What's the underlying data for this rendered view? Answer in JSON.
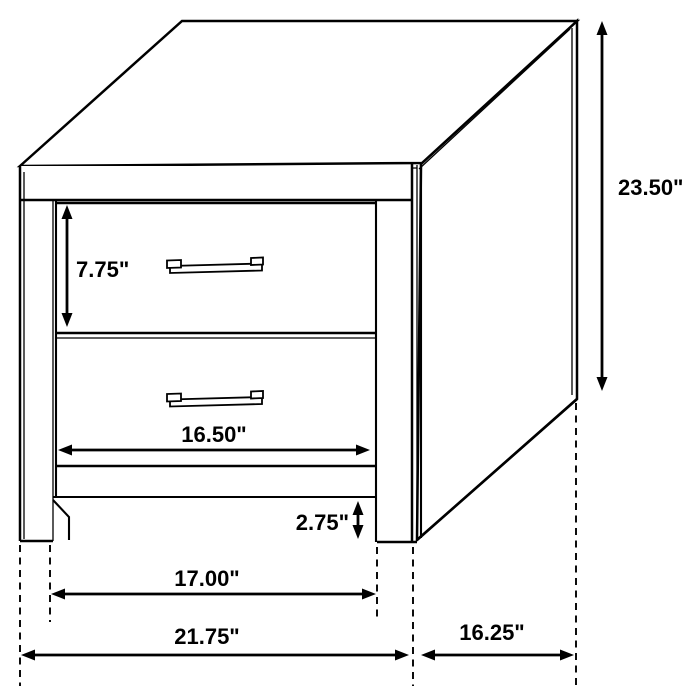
{
  "figure": {
    "kind": "furniture-dimension-diagram",
    "item": "two-drawer nightstand",
    "units": "inches",
    "line_color": "#000000",
    "background_color": "#ffffff",
    "measurements": {
      "overall_height_in": 23.5,
      "overall_width_in": 21.75,
      "depth_in": 16.25,
      "top_drawer_height_in": 7.75,
      "drawer_width_in": 16.5,
      "base_clearance_in": 2.75,
      "leg_span_in": 17.0
    }
  },
  "dimensions": [
    {
      "id": "overall-height",
      "label": "23.50\"",
      "type": "v",
      "x": 602,
      "y1": 21,
      "y2": 391,
      "lx": 618,
      "ly": 195,
      "anchor": "start"
    },
    {
      "id": "top-drawer-height",
      "label": "7.75\"",
      "type": "v",
      "x": 67,
      "y1": 205,
      "y2": 327,
      "lx": 76,
      "ly": 277,
      "anchor": "start"
    },
    {
      "id": "drawer-width",
      "label": "16.50\"",
      "type": "h",
      "y": 450,
      "x1": 58,
      "x2": 370,
      "lx": 214,
      "ly": 442,
      "anchor": "middle"
    },
    {
      "id": "base-height",
      "label": "2.75\"",
      "type": "v",
      "x": 358,
      "y1": 501,
      "y2": 539,
      "lx": 349,
      "ly": 530,
      "anchor": "end"
    },
    {
      "id": "leg-span",
      "label": "17.00\"",
      "type": "h",
      "y": 594,
      "x1": 51,
      "x2": 376,
      "lx": 207,
      "ly": 586,
      "anchor": "middle"
    },
    {
      "id": "overall-width",
      "label": "21.75\"",
      "type": "h",
      "y": 655,
      "x1": 21,
      "x2": 409,
      "lx": 207,
      "ly": 644,
      "anchor": "middle"
    },
    {
      "id": "depth",
      "label": "16.25\"",
      "type": "h",
      "y": 655,
      "x1": 421,
      "x2": 574,
      "lx": 492,
      "ly": 640,
      "anchor": "middle"
    }
  ],
  "extension_lines": [
    {
      "id": "left-outer",
      "x": 20,
      "y1": 545,
      "y2": 686
    },
    {
      "id": "left-leg-inner",
      "x": 50,
      "y1": 545,
      "y2": 622
    },
    {
      "id": "right-leg-inner",
      "x": 377,
      "y1": 547,
      "y2": 622
    },
    {
      "id": "right-front-corner",
      "x": 413,
      "y1": 547,
      "y2": 686
    },
    {
      "id": "back-corner",
      "x": 576,
      "y1": 403,
      "y2": 686
    }
  ]
}
